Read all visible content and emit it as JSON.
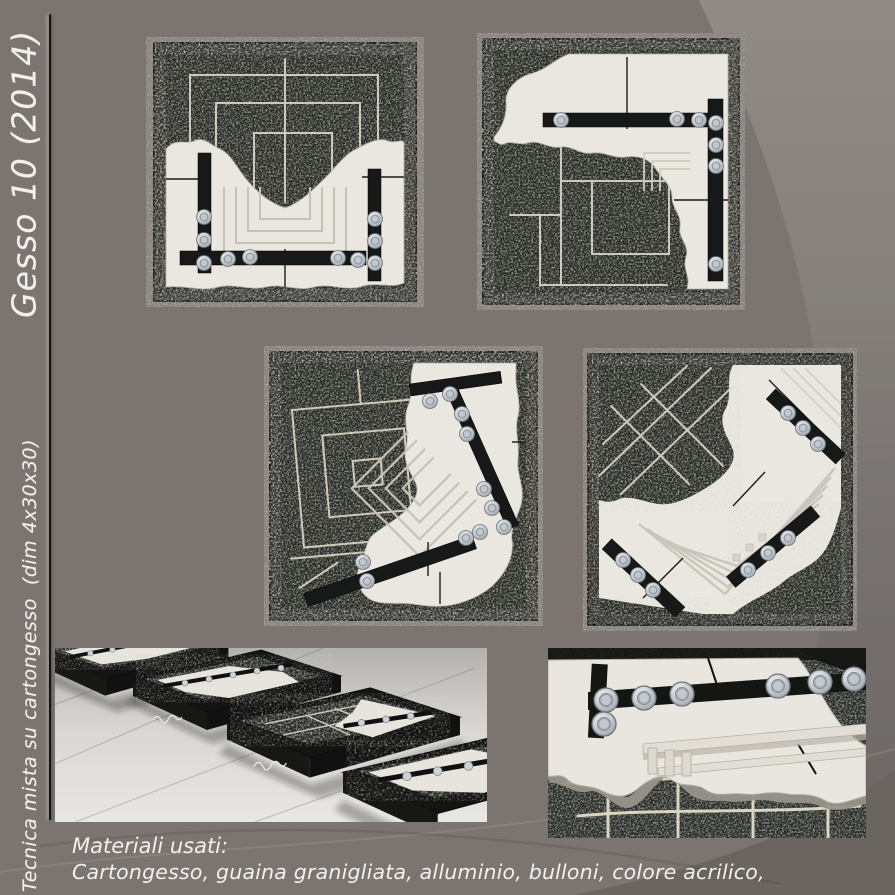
{
  "page": {
    "background_color": "#7b7471",
    "accent_light": "#8f8984",
    "accent_dark": "#6a6561",
    "text_color": "#f2f0ea"
  },
  "sidebar": {
    "title": "Gesso 10 (2014)",
    "subtitle": "Tecnica mista su cartongesso  (dim 4x30x30)"
  },
  "caption": {
    "heading": "Materiali usati:",
    "line": "Cartongesso, guaina granigliata, alluminio, bulloni, colore acrilico,"
  },
  "photos": [
    {
      "id": "artwork-1",
      "description": "Framed panel: plaster fragment with stepped square relief, vertical and horizontal aluminium bars fixed with bolts over granulated black ground with chalked concentric squares"
    },
    {
      "id": "artwork-2",
      "description": "Framed panel: corner-shaped plaster fragment with aluminium bars and bolts, chalked square grid on granulated black ground"
    },
    {
      "id": "artwork-3",
      "description": "Framed panel: diagonal plaster fragment with rotated stepped relief, diagonal aluminium bars with many bolts, chalked square spiral"
    },
    {
      "id": "artwork-4",
      "description": "Framed panel: plaster field with chevron relief, three diagonal aluminium bars with bolts, granulated patch with chalked diagonal grid"
    },
    {
      "id": "installation-view",
      "description": "Four framed panels lying in a row on a glossy floor seen in perspective, artist signature on the frame edges"
    },
    {
      "id": "detail-view",
      "description": "Close-up of a plaster fragment edge with hex bolts and washers on a black aluminium bar over granulated ground with chalk grid"
    }
  ]
}
